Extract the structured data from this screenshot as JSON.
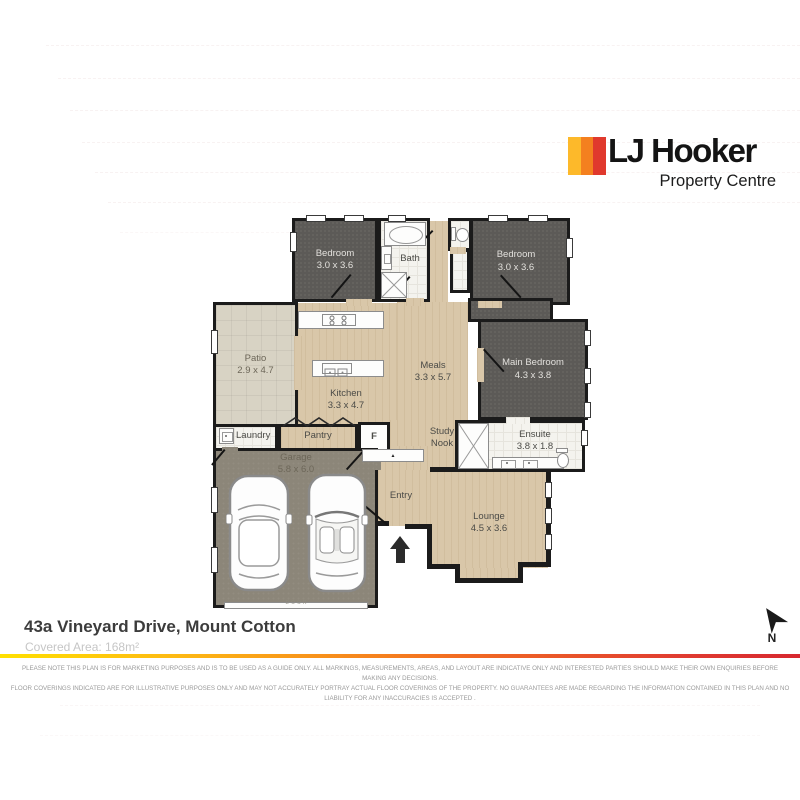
{
  "logo": {
    "brand": "LJ Hooker",
    "subtitle": "Property Centre",
    "stripe_colors": [
      "#FDB92A",
      "#F4801F",
      "#E0392D"
    ]
  },
  "plan": {
    "rooms": [
      {
        "id": "bedroom-left",
        "label": "Bedroom",
        "dims": "3.0 x 3.6"
      },
      {
        "id": "bath",
        "label": "Bath",
        "dims": ""
      },
      {
        "id": "bedroom-right",
        "label": "Bedroom",
        "dims": "3.0 x 3.6"
      },
      {
        "id": "patio",
        "label": "Patio",
        "dims": "2.9 x 4.7"
      },
      {
        "id": "kitchen",
        "label": "Kitchen",
        "dims": "3.3 x 4.7"
      },
      {
        "id": "meals",
        "label": "Meals",
        "dims": "3.3 x 5.7"
      },
      {
        "id": "main-bedroom",
        "label": "Main Bedroom",
        "dims": "4.3 x 3.8"
      },
      {
        "id": "ensuite",
        "label": "Ensuite",
        "dims": "3.8 x 1.8"
      },
      {
        "id": "laundry",
        "label": "Laundry",
        "dims": ""
      },
      {
        "id": "pantry",
        "label": "Pantry",
        "dims": ""
      },
      {
        "id": "fridge",
        "label": "F",
        "dims": ""
      },
      {
        "id": "study-nook",
        "label": "Study Nook",
        "dims": ""
      },
      {
        "id": "garage",
        "label": "Garage",
        "dims": "5.8 x 6.0"
      },
      {
        "id": "entry",
        "label": "Entry",
        "dims": ""
      },
      {
        "id": "lounge",
        "label": "Lounge",
        "dims": "4.5 x 3.6"
      }
    ],
    "garage_door_label": "DOOR",
    "compass_label": "N"
  },
  "footer": {
    "address": "43a Vineyard Drive, Mount Cotton",
    "covered_area": "Covered Area: 168m²",
    "disclaimer_line1": "PLEASE NOTE THIS PLAN IS FOR MARKETING PURPOSES AND IS TO BE USED AS A GUIDE ONLY.  ALL MARKINGS, MEASUREMENTS, AREAS, AND LAYOUT ARE INDICATIVE ONLY AND INTERESTED PARTIES SHOULD MAKE THEIR OWN ENQUIRIES BEFORE MAKING ANY DECISIONS.",
    "disclaimer_line2": "FLOOR COVERINGS INDICATED ARE FOR ILLUSTRATIVE PURPOSES ONLY AND MAY NOT ACCURATELY PORTRAY ACTUAL FLOOR COVERINGS OF THE PROPERTY.  NO GUARANTEES ARE MADE REGARDING THE INFORMATION CONTAINED IN THIS PLAN AND NO LIABILITY FOR  ANY INACCURACIES IS ACCEPTED ."
  },
  "colors": {
    "wall": "#1b1b1b",
    "carpet": "#5c5a57",
    "timber_floor": "#d9c7a9",
    "patio_tile": "#d8d3c4",
    "garage_floor": "#8c8679",
    "wet_area_tile": "#f4f3ee",
    "divider_gradient": [
      "#ffe000",
      "#fdb913",
      "#f37021",
      "#e03c31"
    ]
  }
}
